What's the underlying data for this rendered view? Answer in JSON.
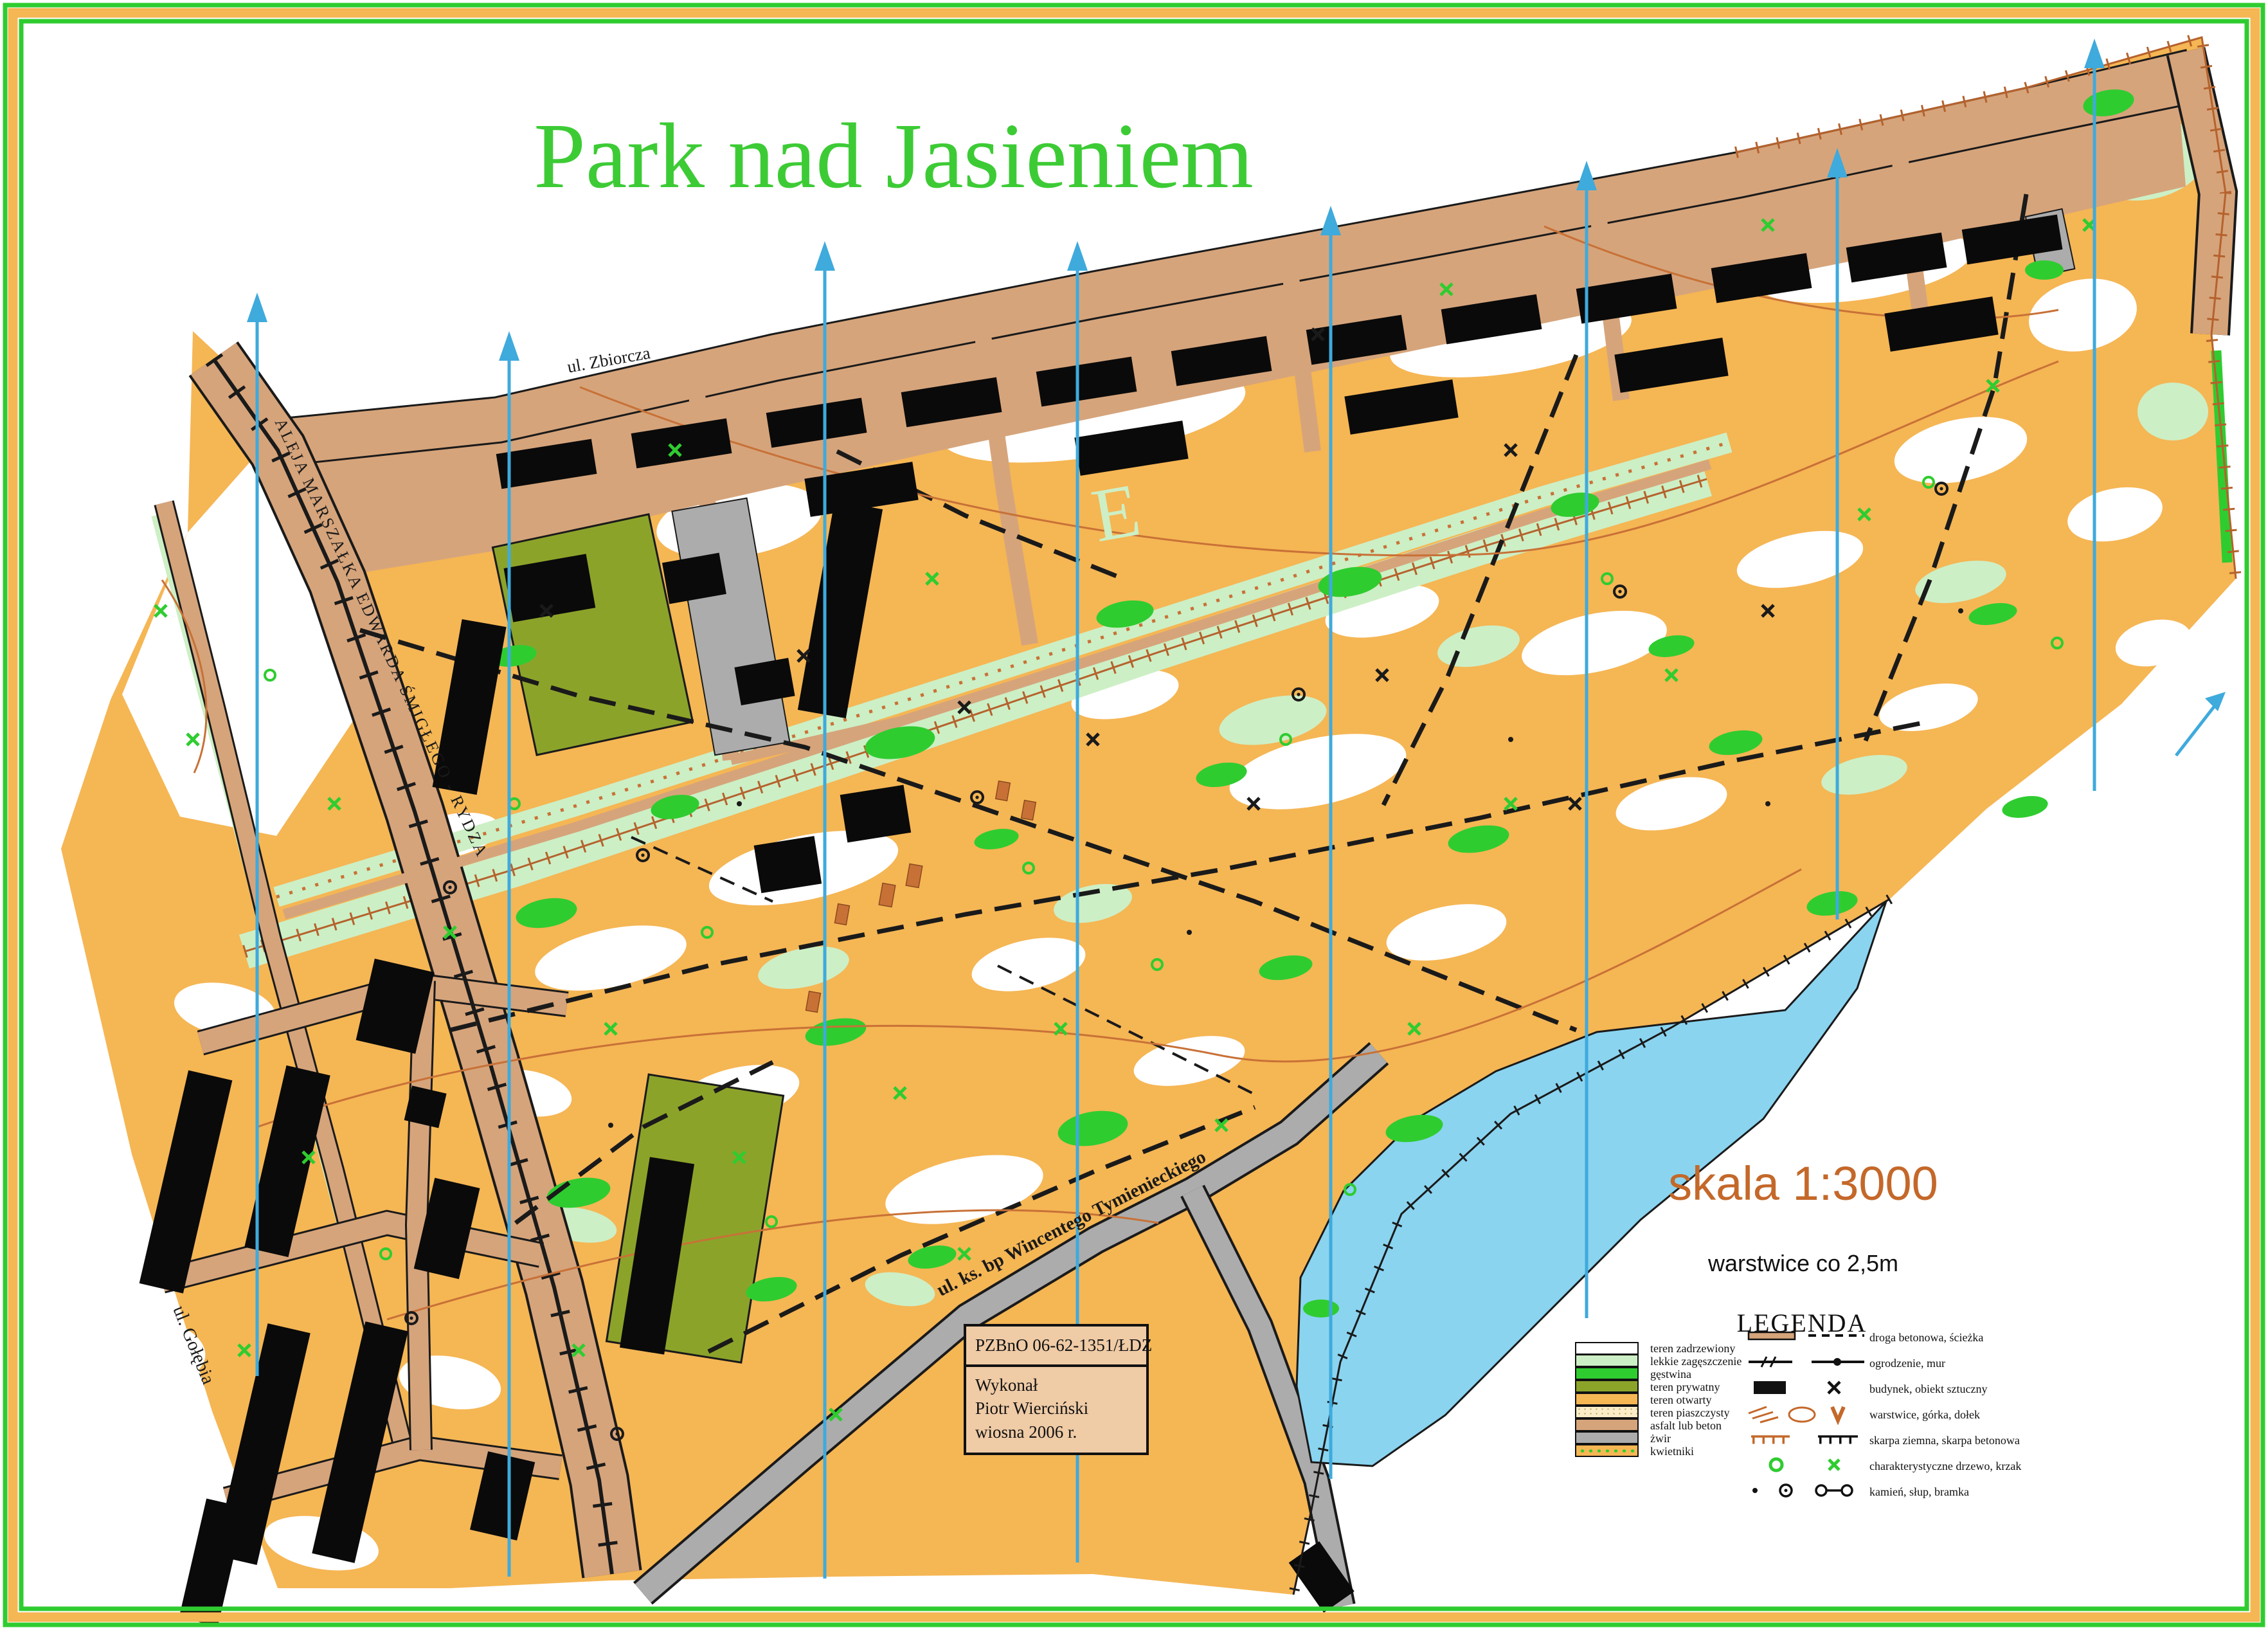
{
  "title": "Park nad Jasieniem",
  "watermark": "E",
  "streets": {
    "aleja": "ALEJA MARSZAŁKA EDWARDA ŚMIGŁEGO - RYDZA",
    "zbiorcza": "ul. Zbiorcza",
    "tymienieckiego": "ul. ks. bp Wincentego Tymienieckiego",
    "golebia": "ul. Gołębia"
  },
  "scale_block": {
    "scale": "skala 1:3000",
    "contours": "warstwice co 2,5m"
  },
  "legend": {
    "heading": "LEGENDA",
    "terrain": [
      {
        "label": "teren zadrzewiony",
        "color": "#FFFFFF"
      },
      {
        "label": "lekkie zagęszczenie",
        "color": "#CDEFC5"
      },
      {
        "label": "gęstwina",
        "color": "#2FCC30"
      },
      {
        "label": "teren prywatny",
        "color": "#8CA32A"
      },
      {
        "label": "teren otwarty",
        "color": "#F5B654"
      },
      {
        "label": "teren piaszczysty",
        "color": "#FAEDC8"
      },
      {
        "label": "asfalt lub beton",
        "color": "#D6A47B"
      },
      {
        "label": "żwir",
        "color": "#ACACAC"
      },
      {
        "label": "kwietniki",
        "color": "#F5B654"
      }
    ],
    "symbols": [
      {
        "label": "droga betonowa, ścieżka"
      },
      {
        "label": "ogrodzenie, mur"
      },
      {
        "label": "budynek, obiekt sztuczny"
      },
      {
        "label": "warstwice, górka, dołek"
      },
      {
        "label": "skarpa ziemna, skarpa betonowa"
      },
      {
        "label": "charakterystyczne drzewo, krzak"
      },
      {
        "label": "kamień, słup, bramka"
      }
    ]
  },
  "credits": {
    "license": "PZBnO   06-62-1351/ŁDZ",
    "made_by": "Wykonał",
    "author": "Piotr Wierciński",
    "date": "wiosna 2006 r."
  },
  "colors": {
    "frame_green": "#2FCC30",
    "open_terrain": "#F5B654",
    "light_green": "#CDEFC5",
    "private_olive": "#8CA32A",
    "asphalt_tan": "#D6A47B",
    "gravel_gray": "#ACACAC",
    "sand": "#FAEDC8",
    "lake_blue": "#8AD4F0",
    "north_line_cyan": "#3FAADC",
    "title_green": "#3DCB35",
    "scale_orange": "#C4682A",
    "contour_brown": "#C87137"
  }
}
